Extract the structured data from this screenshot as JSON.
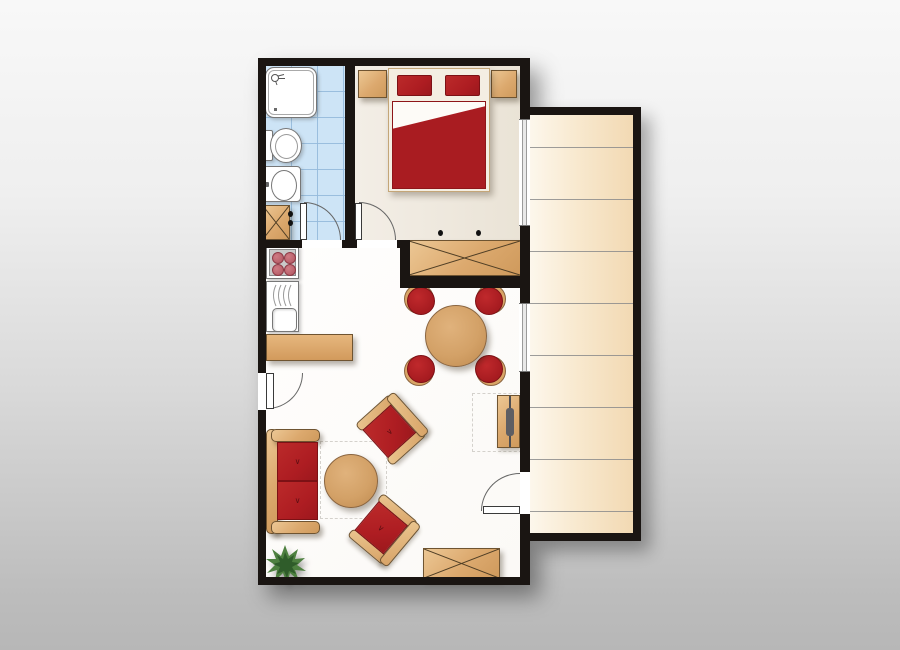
{
  "title": "apartment-floor-plan",
  "rooms": [
    {
      "id": "bathroom",
      "label": "Bathroom"
    },
    {
      "id": "bedroom",
      "label": "Bedroom"
    },
    {
      "id": "living-kitchen",
      "label": "Living room with kitchenette"
    },
    {
      "id": "terrace",
      "label": "Terrace"
    }
  ],
  "furniture": {
    "bathroom": [
      "Shower",
      "Toilet",
      "Washbasin",
      "Bathroom cabinet"
    ],
    "bedroom": [
      "Double bed with red duvet",
      "Left pillow",
      "Right pillow",
      "Left nightstand",
      "Right nightstand",
      "Built-in closet"
    ],
    "kitchen": [
      "Stove with 4 burners",
      "Sink with drainer",
      "Kitchen counter"
    ],
    "living": [
      "Two-seat sofa",
      "Coffee table",
      "Upper armchair",
      "Lower armchair",
      "Round dining table",
      "Dining stool",
      "TV sideboard",
      "Wardrobe",
      "Potted plant",
      "Rug outline",
      "Clearance outline"
    ],
    "doors": [
      "Entrance door",
      "Bathroom door",
      "Bedroom door",
      "Terrace door"
    ],
    "windows": [
      "Bedroom window",
      "Living room window"
    ]
  },
  "counts": {
    "dining_stools": 4,
    "terrace_planks": 9
  },
  "colors": {
    "wall": "#1a1512",
    "accent_red": "#ae1d22",
    "wood": "#dca96e",
    "bathroom_tile": "#cde4f6",
    "bedroom_floor": "#ede7db",
    "living_floor": "#fdfdfc",
    "terrace_deck": "#f6e3c4",
    "background_top": "#f8f8f8",
    "background_bottom": "#b7b7b7"
  }
}
